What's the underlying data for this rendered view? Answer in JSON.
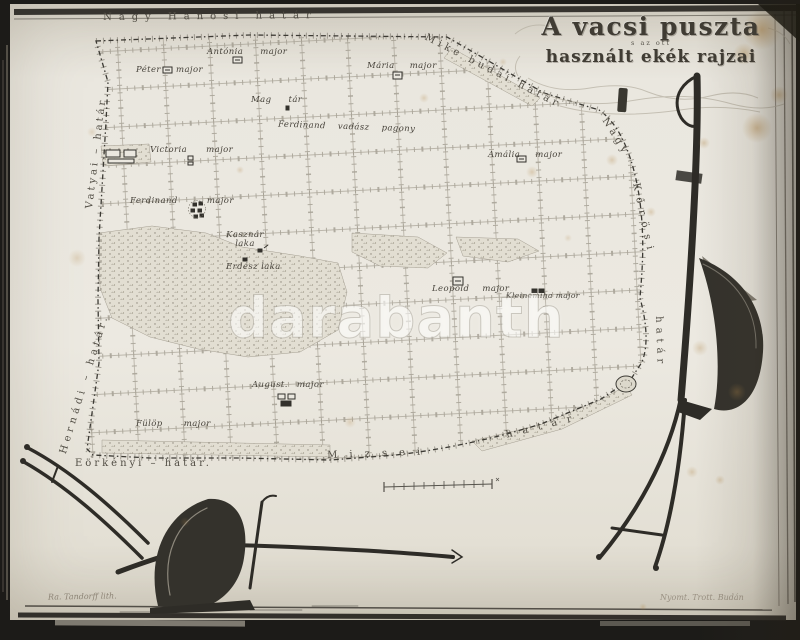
{
  "title": {
    "line1": "A vacsi puszta",
    "interline": "s az ott",
    "line2": "használt ekék rajzai"
  },
  "watermark": "darabanth",
  "borders": {
    "top": "Nagy Hanosi határ",
    "top_right": "Mike budai határ",
    "right_upper": "Nagy",
    "right_middle": "Kőrösi",
    "right_lower": "határ",
    "left_upper": "Vatyai – határ",
    "left_lower": "Hernádi – határ.",
    "bottom_left": "Eörkényi – határ.",
    "bottom_middle": "Mizsei",
    "bottom_right": "határ."
  },
  "places": [
    {
      "name": "Antónia major"
    },
    {
      "name": "Péter major"
    },
    {
      "name": "Mária major"
    },
    {
      "name": "Mag tár"
    },
    {
      "name": "Ferdinand vadász pagony"
    },
    {
      "name": "Victoria major"
    },
    {
      "name": "Amália major"
    },
    {
      "name": "Ferdinand major"
    },
    {
      "name": "Kasznár\nlaka"
    },
    {
      "name": "Erdész laka"
    },
    {
      "name": "Leopold major"
    },
    {
      "name": "Kleinemiha major"
    },
    {
      "name": "August. major"
    },
    {
      "name": "Fülöp major"
    }
  ],
  "credits": {
    "lithographer": "Ra. Tandorff lith.",
    "printer": "Nyomt. Trott. Budán"
  }
}
